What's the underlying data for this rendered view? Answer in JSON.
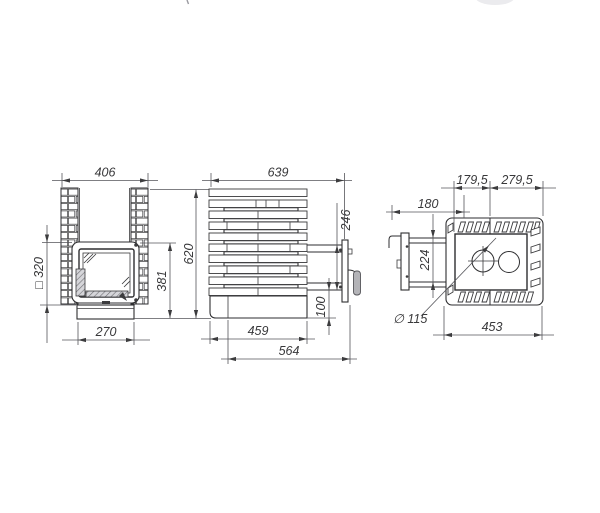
{
  "drawing": {
    "title": "stove-dimension-drawing",
    "line_color": "#2e2e30",
    "dim_color": "#55555a",
    "text_color": "#38383a",
    "front_view": {
      "dims": {
        "top_width": "406",
        "door_square": "□ 320",
        "door_height": "381",
        "overall_height": "620",
        "base_width": "270"
      }
    },
    "side_view": {
      "dims": {
        "top_depth": "639",
        "mount_span": "246",
        "mount_to_base": "100",
        "base_depth": "459",
        "overall_depth": "564"
      }
    },
    "top_view": {
      "dims": {
        "front_offset": "179,5",
        "rear_offset": "279,5",
        "handle_depth": "180",
        "mount_span": "224",
        "chimney_diameter": "∅ 115",
        "overall_width": "453"
      }
    }
  }
}
